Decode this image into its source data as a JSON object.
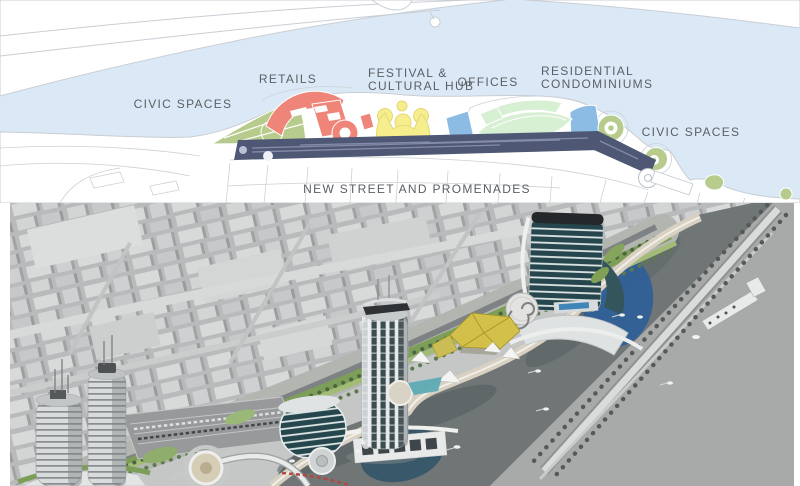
{
  "board": {
    "plan": {
      "labels": {
        "civic_left": "CIVIC SPACES",
        "retails": "RETAILS",
        "festival_line1": "FESTIVAL &",
        "festival_line2": "CULTURAL HUB",
        "offices": "OFFICES",
        "residential_line1": "RESIDENTIAL",
        "residential_line2": "CONDOMINIUMS",
        "civic_right": "CIVIC SPACES",
        "street": "NEW STREET AND PROMENADES"
      },
      "colors": {
        "water": "#dbe9f6",
        "land": "#ffffff",
        "outline": "#c9ced4",
        "civic_green": "#b7cb8c",
        "retail_red": "#ef8478",
        "festival_yellow": "#f6ee8d",
        "offices_blue": "#8cbce4",
        "residential_mint": "#d7efd3",
        "street_navy": "#4e5773",
        "label_text": "#5a5f64"
      }
    },
    "render": {
      "colors": {
        "city_grey": "#c5c6c6",
        "river_grey": "#707576",
        "bank_grey": "#a8aaaa",
        "park_green": "#7d9e58",
        "plaza_blue": "#2e5f98",
        "festival_yellow": "#d2c04b",
        "glass_teal": "#24464c",
        "promenade_tan": "#d8d0c1"
      }
    }
  }
}
